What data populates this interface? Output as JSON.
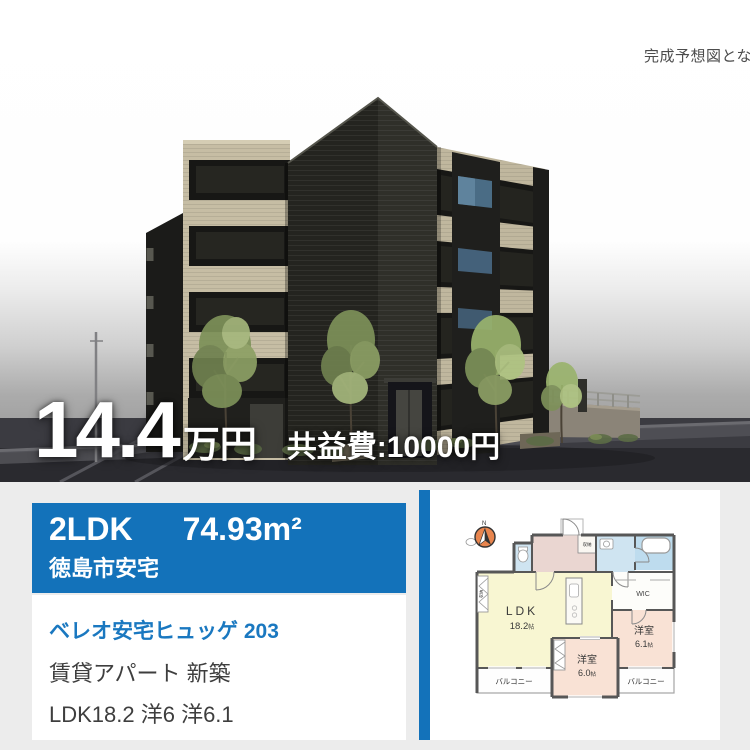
{
  "photo": {
    "caption": "完成予想図となり",
    "price": {
      "amount": "14.4",
      "unit": "万円",
      "common_fee": "共益費:10000円"
    }
  },
  "banner": {
    "layout": "2LDK",
    "area": "74.93m²",
    "location": "徳島市安宅",
    "bg_color": "#1372ba"
  },
  "info": {
    "name": "ベレオ安宅ヒュッゲ 203",
    "name_color": "#1a78c0",
    "type_line": "賃貸アパート 新築",
    "rooms_line": "LDK18.2 洋6 洋6.1"
  },
  "floorplan": {
    "compass_n": "N",
    "ldk": {
      "label": "LDK",
      "size": "18.2",
      "unit": "帖"
    },
    "bedroom_right": {
      "label": "洋室",
      "size": "6.1",
      "unit": "帖"
    },
    "bedroom_bottom": {
      "label": "洋室",
      "size": "6.0",
      "unit": "帖"
    },
    "wic": "WIC",
    "closet_entrance": "収納",
    "closet_ldk": "収納",
    "balcony_left": "バルコニー",
    "balcony_right": "バルコニー",
    "colors": {
      "ldk": "#f8f6d2",
      "bedroom": "#f9e2d5",
      "wet_area": "#cfe4f1",
      "hall": "#ead6d1",
      "wall": "#575757",
      "compass": "#e8854e"
    }
  }
}
